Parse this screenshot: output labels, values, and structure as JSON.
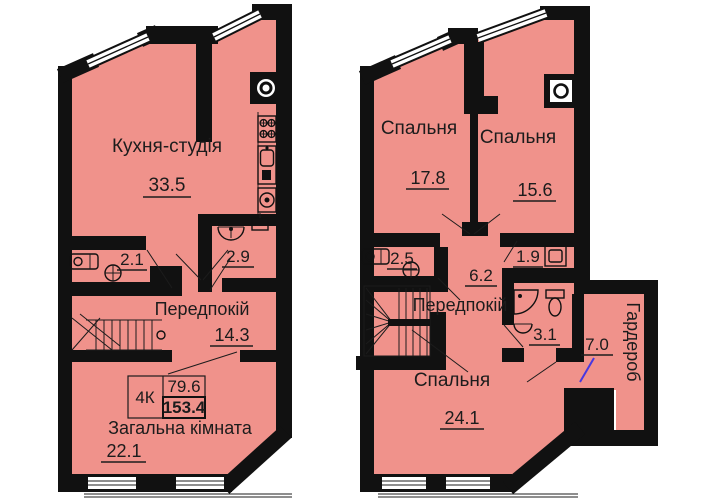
{
  "colors": {
    "floor": "#F0928B",
    "wall": "#111111",
    "text": "#1C1C1C",
    "annotation_line": "#4838E0"
  },
  "left_plan": {
    "kitchen": {
      "label": "Кухня-студія",
      "area": "33.5"
    },
    "wc": {
      "area": "2.1"
    },
    "bathroom": {
      "area": "2.9"
    },
    "hallway": {
      "label": "Передпокій",
      "area": "14.3"
    },
    "living_room": {
      "label": "Загальна кімната",
      "area": "22.1"
    },
    "info_box": {
      "type": "4К",
      "living_area": "79.6",
      "total_area": "153.4"
    }
  },
  "right_plan": {
    "bedroom_1": {
      "label": "Спальня",
      "area": "17.8"
    },
    "bedroom_2": {
      "label": "Спальня",
      "area": "15.6"
    },
    "bathroom_1": {
      "area": "2.5"
    },
    "laundry": {
      "area": "1.9"
    },
    "corridor": {
      "area": "6.2"
    },
    "hallway": {
      "label": "Передпокій"
    },
    "bathroom_2": {
      "area": "3.1"
    },
    "wardrobe": {
      "label": "Гардероб",
      "area": "7.0"
    },
    "bedroom_3": {
      "label": "Спальня",
      "area": "24.1"
    }
  }
}
